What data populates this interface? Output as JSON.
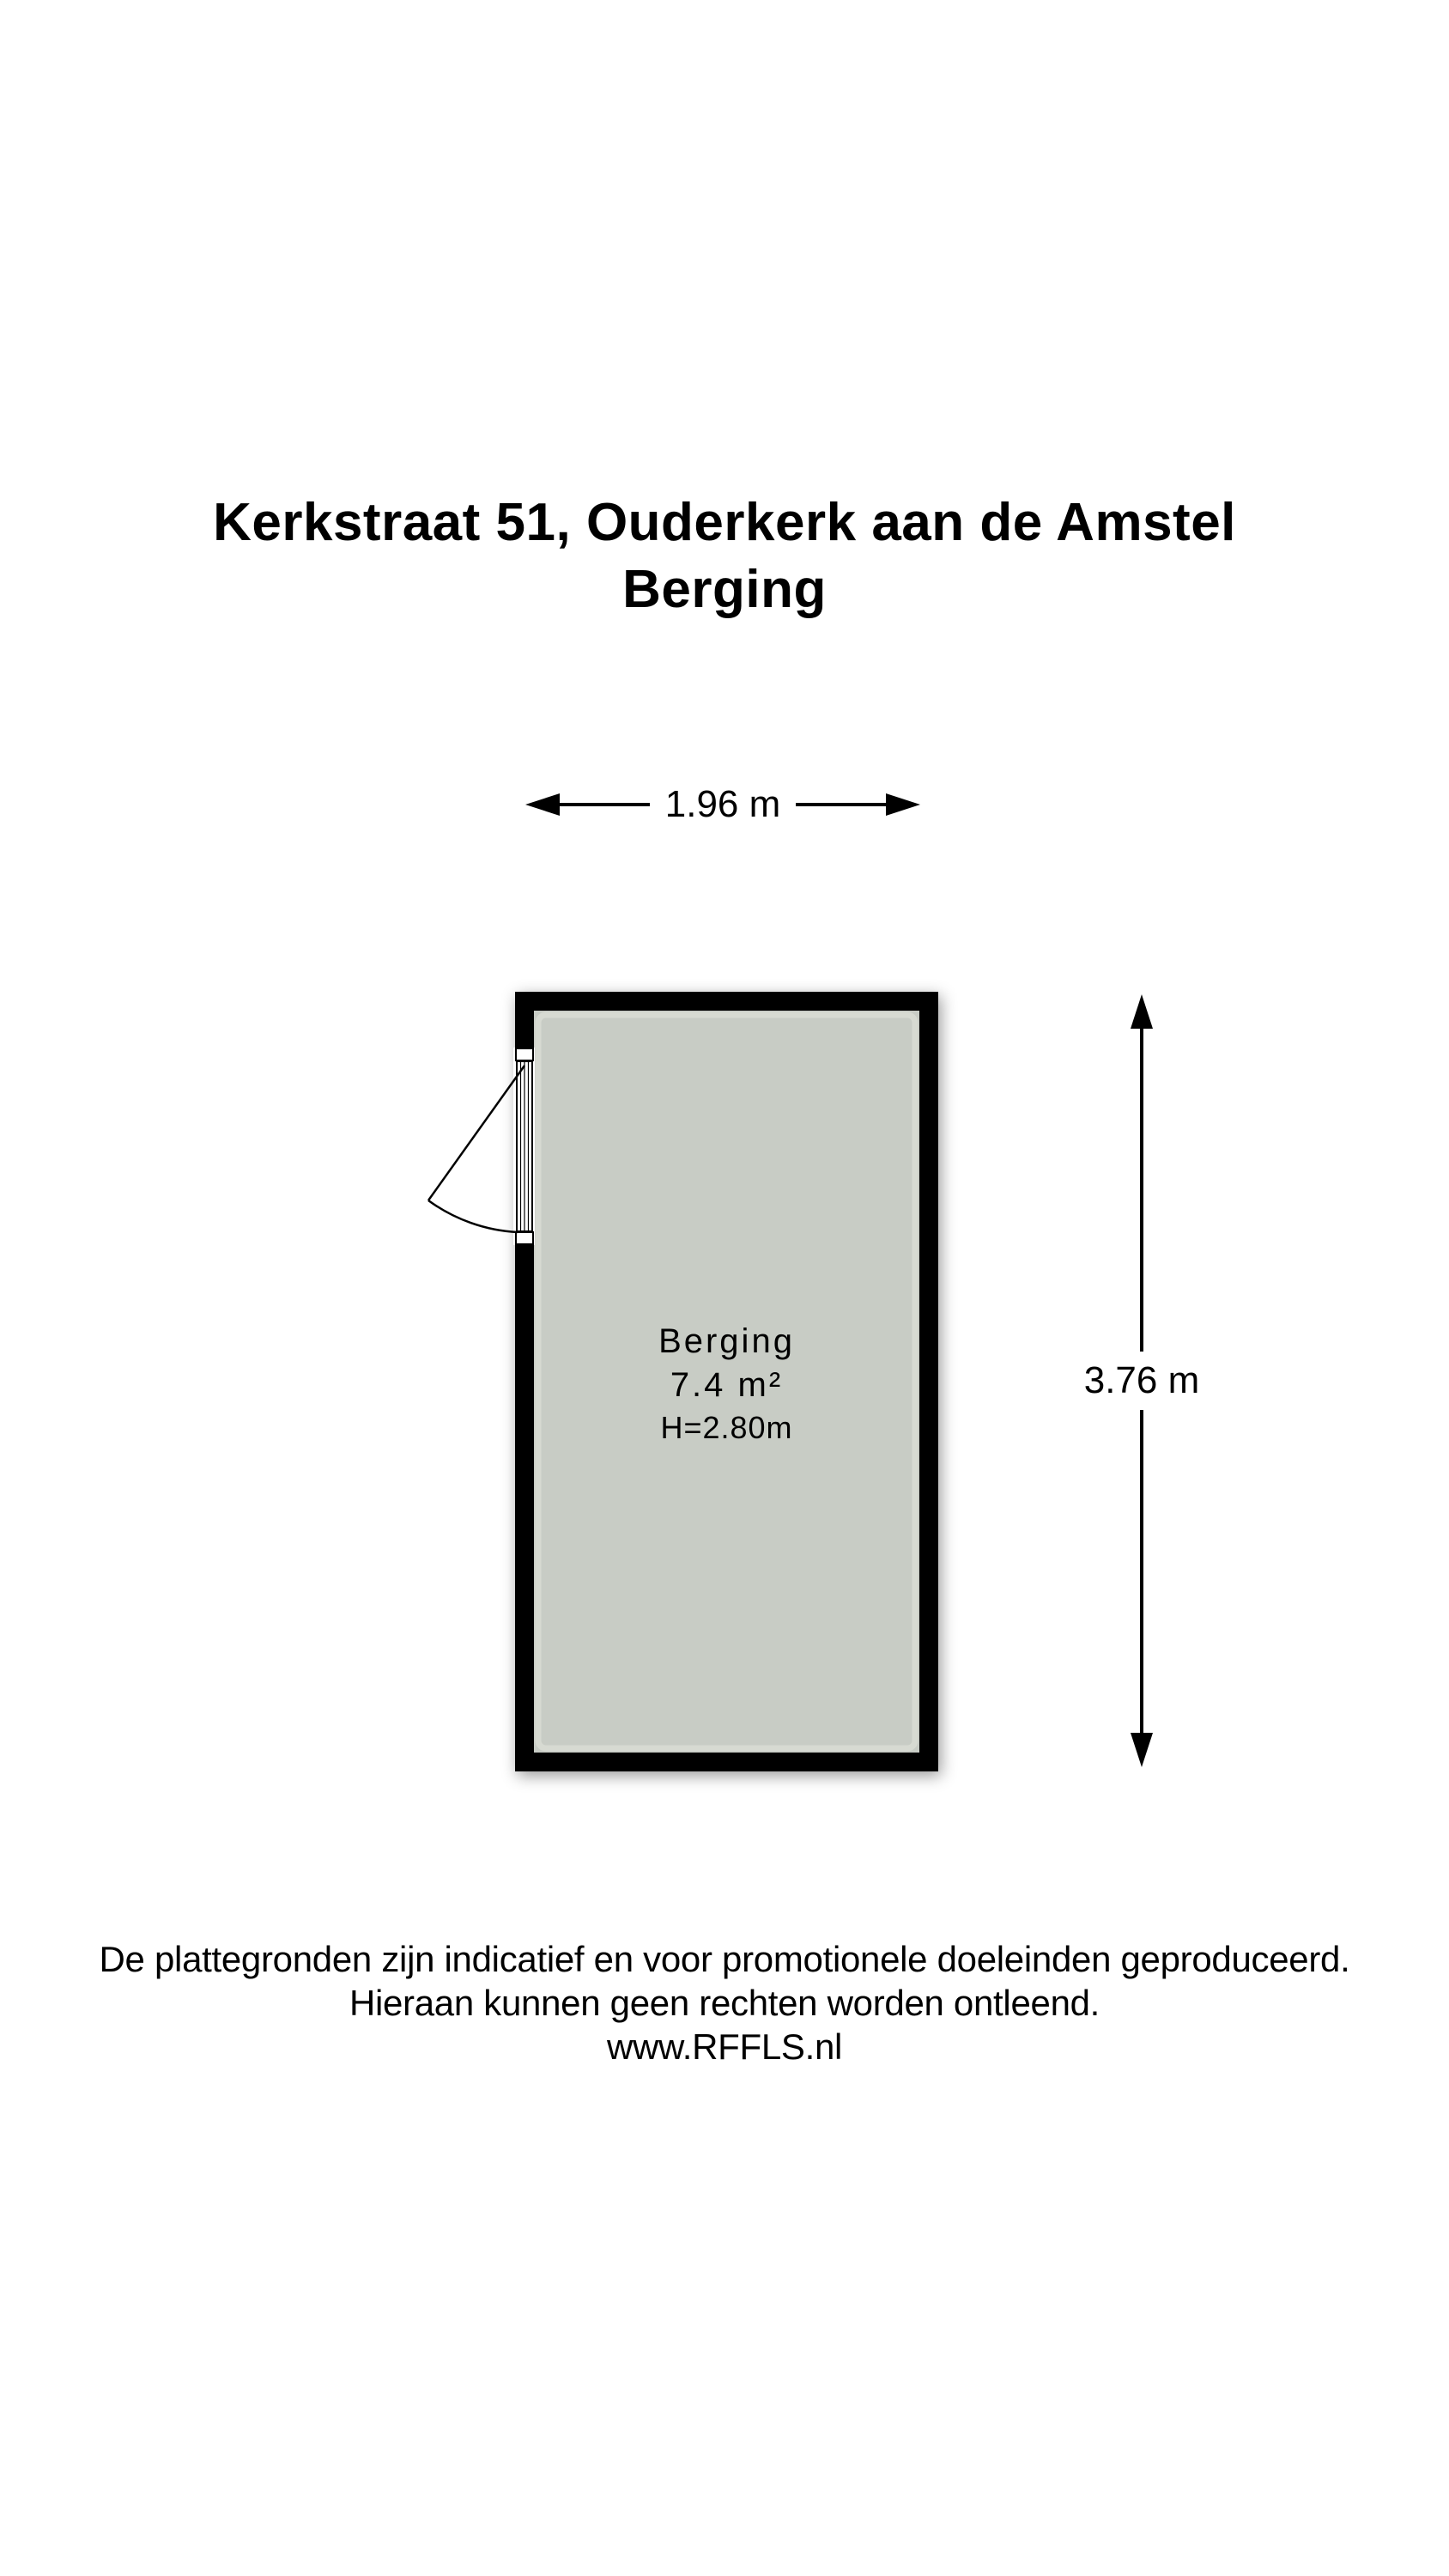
{
  "header": {
    "address": "Kerkstraat 51, Ouderkerk aan de Amstel",
    "floor_label": "Berging"
  },
  "floorplan": {
    "room": {
      "name": "Berging",
      "area": "7.4 m²",
      "ceiling_height": "H=2.80m"
    },
    "dimensions": {
      "width": "1.96 m",
      "height": "3.76 m"
    },
    "colors": {
      "wall": "#000000",
      "floor": "#c8ccc5",
      "floor_bevel": "#d9dcd4"
    }
  },
  "footer": {
    "disclaimer_line1": "De plattegronden zijn indicatief en voor promotionele doeleinden geproduceerd.",
    "disclaimer_line2": "Hieraan kunnen geen rechten worden ontleend.",
    "website": "www.RFFLS.nl"
  }
}
